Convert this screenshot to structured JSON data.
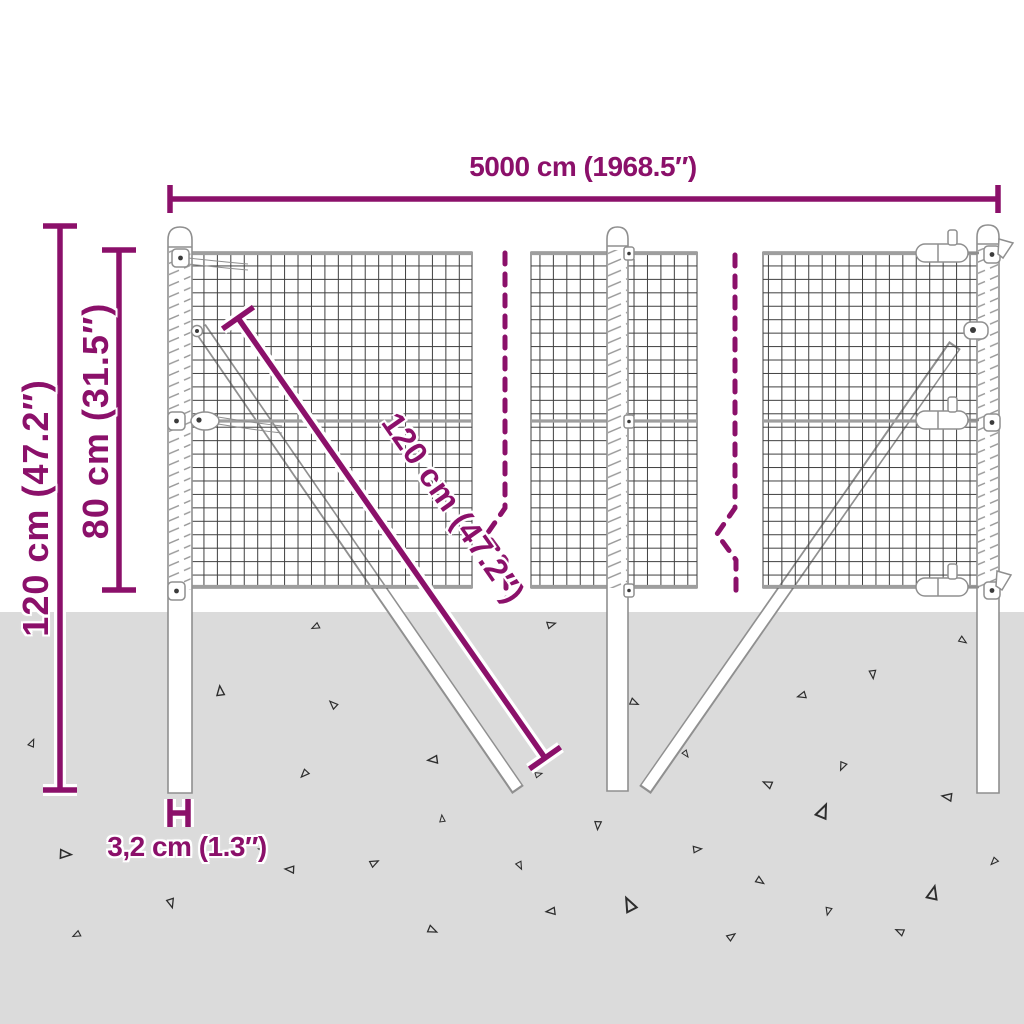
{
  "diagram": {
    "kind": "product-dimension-diagram",
    "subject": "wire mesh fence with posts and ground anchoring",
    "labels": {
      "total_width": "5000 cm (1968.5″)",
      "total_height": "120 cm (47.2″)",
      "mesh_height": "80 cm (31.5″)",
      "brace_length": "120 cm (47.2″)",
      "post_width": "3,2 cm (1.3″)"
    },
    "colors": {
      "dimension_accent": "#8b106a",
      "ground": "#dbdbdb",
      "line_art_gray": "#8f8f8f",
      "mesh_line": "#3f3f3f"
    }
  }
}
